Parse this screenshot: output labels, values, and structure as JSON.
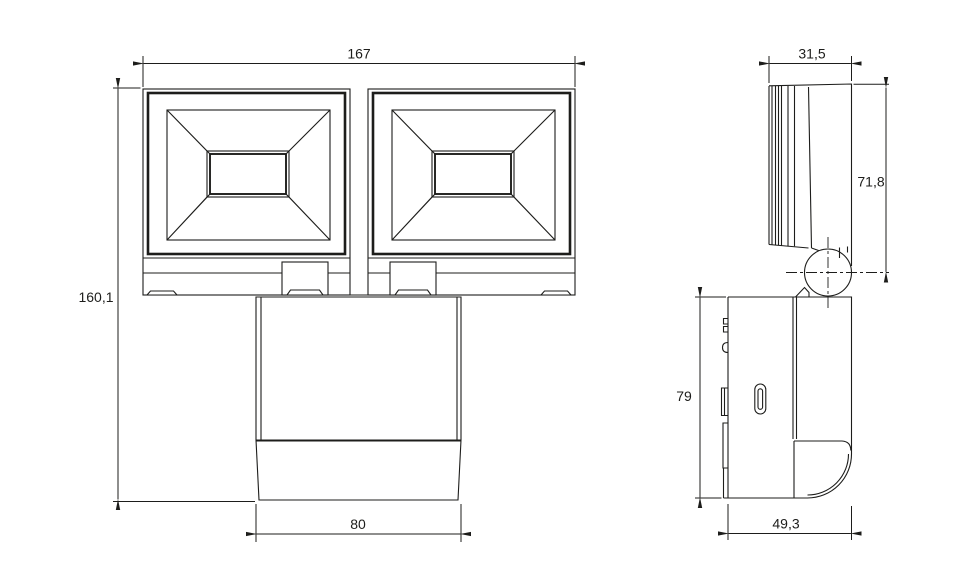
{
  "colors": {
    "background": "#ffffff",
    "line": "#1d1d1b"
  },
  "dimensions": {
    "front_width": {
      "label": "167"
    },
    "front_height": {
      "label": "160,1"
    },
    "mount_front_width": {
      "label": "80"
    },
    "head_depth": {
      "label": "31,5"
    },
    "head_side_height": {
      "label": "71,8"
    },
    "mount_side_height": {
      "label": "79"
    },
    "mount_side_depth": {
      "label": "49,3"
    }
  }
}
